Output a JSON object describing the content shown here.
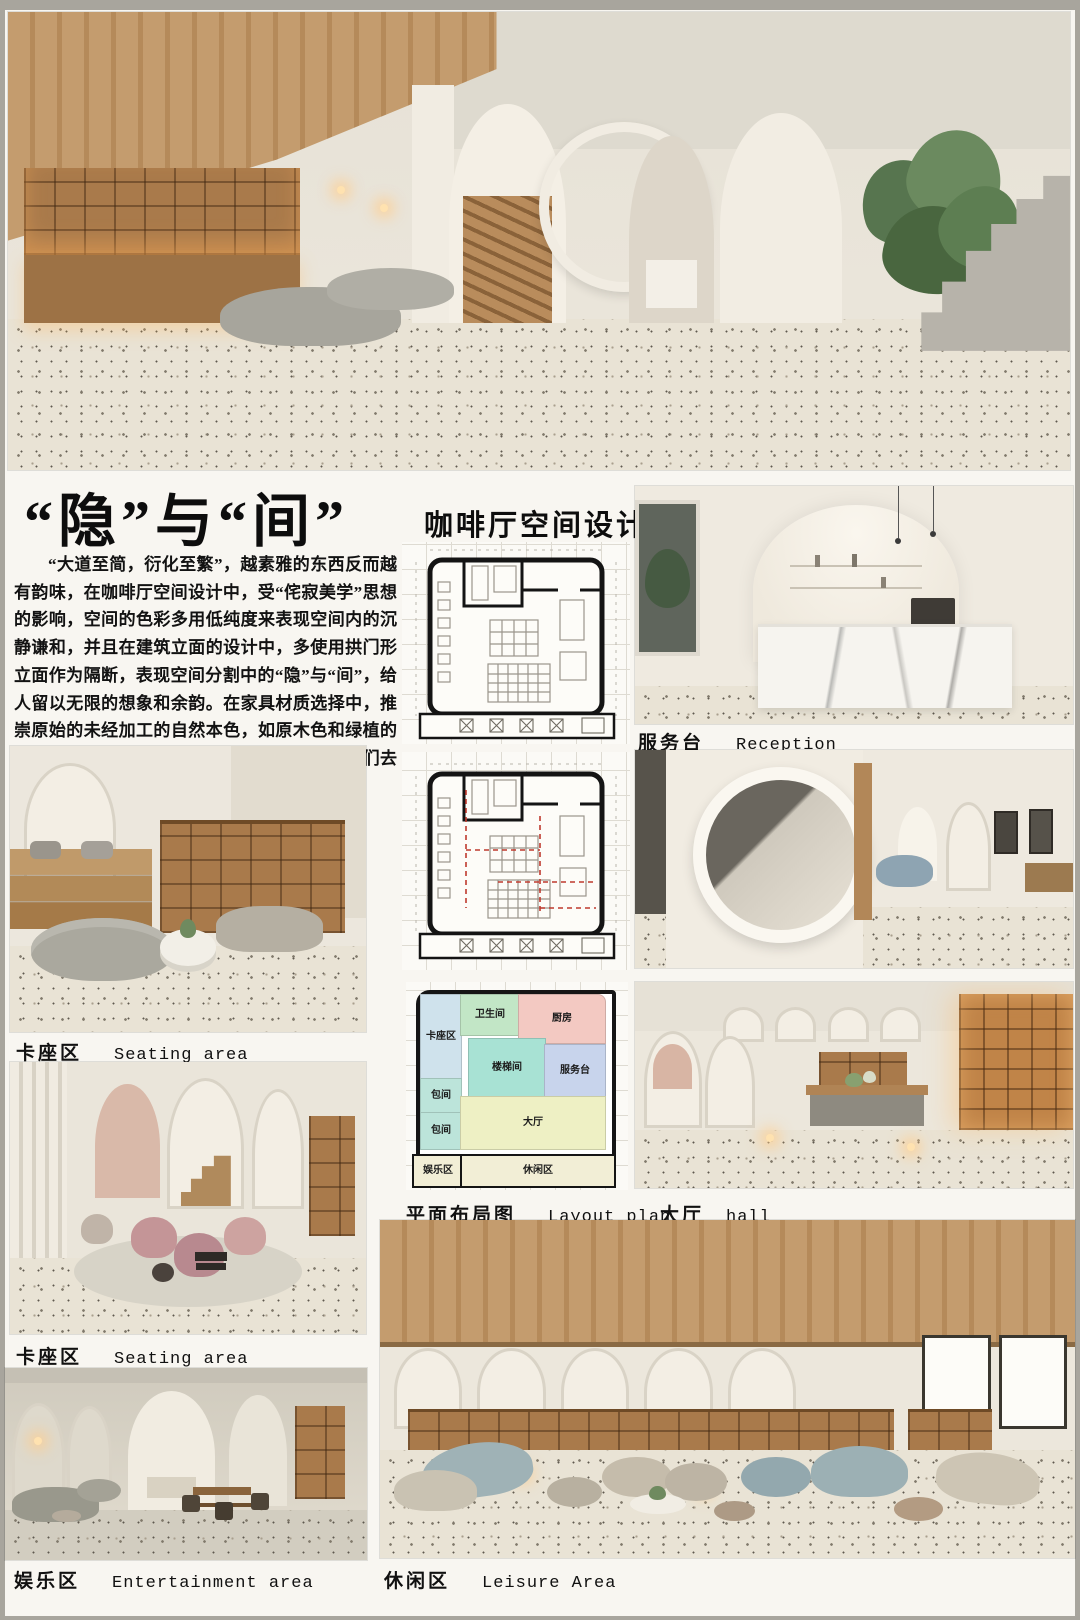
{
  "header": {
    "title": "“隐”与“间”",
    "subtitle": "咖啡厅空间设计"
  },
  "intro": "“大道至简，衍化至繁”，越素雅的东西反而越有韵味，在咖啡厅空间设计中，受“侘寂美学”思想的影响，空间的色彩多用低纯度来表现空间内的沉静谦和，并且在建筑立面的设计中，多使用拱门形立面作为隔断，表现空间分割中的“隐”与“间”，给人留以无限的想象和余韵。在家具材质选择中，推崇原始的未经加工的自然本色，如原木色和绿植的使用，打造一种温馨雅致的空间氛围，从而人们去品味咖啡、静心体悟生活。",
  "captions": {
    "reception": {
      "cn": "服务台",
      "en": "Reception"
    },
    "corridor": {
      "cn": "走廊",
      "en": "corridor"
    },
    "seating1": {
      "cn": "卡座区",
      "en": "Seating area"
    },
    "layout_plan": {
      "cn": "平面布局图",
      "en": "Layout plan"
    },
    "hall": {
      "cn": "大厅",
      "en": "hall"
    },
    "seating2": {
      "cn": "卡座区",
      "en": "Seating area"
    },
    "entertainment": {
      "cn": "娱乐区",
      "en": "Entertainment area"
    },
    "leisure": {
      "cn": "休闲区",
      "en": "Leisure Area"
    }
  },
  "layout_plan": {
    "rooms": [
      {
        "id": "restroom",
        "label": "卫生间",
        "color": "#c2e6c6"
      },
      {
        "id": "kitchen",
        "label": "厨房",
        "color": "#f3c9c2"
      },
      {
        "id": "booth-zone",
        "label": "卡座区",
        "color": "#cfe2ec"
      },
      {
        "id": "stairwell",
        "label": "楼梯间",
        "color": "#a8e2d4"
      },
      {
        "id": "service-desk",
        "label": "服务台",
        "color": "#c8d4ec"
      },
      {
        "id": "private-room-1",
        "label": "包间",
        "color": "#bce4da"
      },
      {
        "id": "private-room-2",
        "label": "包间",
        "color": "#bce4da"
      },
      {
        "id": "main-hall",
        "label": "大厅",
        "color": "#eef0c4"
      },
      {
        "id": "entertainment-zone",
        "label": "娱乐区",
        "color": "#f2eed6"
      },
      {
        "id": "leisure-zone",
        "label": "休闲区",
        "color": "#f2eed6"
      }
    ]
  }
}
